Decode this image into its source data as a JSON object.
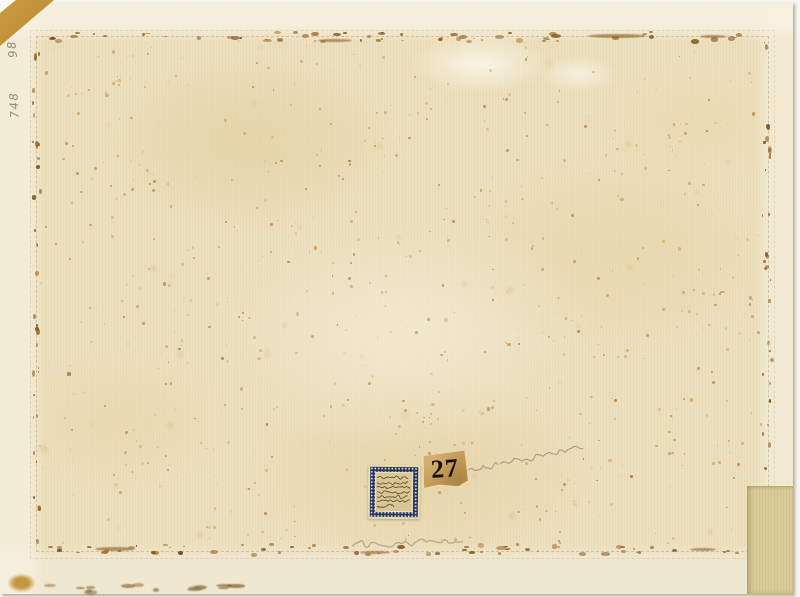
{
  "scan": {
    "description": "Back of an aged archival sheet with heavy foxing, a rectangular mount glue-line of brown specks, pasted collection labels and faint pencil notations",
    "inscriptions": {
      "number_tag": "27",
      "margin_number_top": "98",
      "margin_number_bottom": "748",
      "stamp_label_text": "illegible handwritten ink lines",
      "stamp_label_line_count": 7,
      "pencil_note_right": "illegible cursive pencil note",
      "pencil_note_bottom": "illegible cursive pencil note"
    },
    "colors": {
      "paper": "#ecdfbc",
      "paper_margin": "#f4eed9",
      "foxing_light": "#d2ab66",
      "foxing_mid": "#b97f33",
      "foxing_dark": "#a06a24",
      "glue_speck": "#8a5a1e",
      "backing_tan": "#c89a44",
      "patch_tan": "#d9cd97",
      "tag_paper": "#c69c58",
      "tag_ink": "#17100a",
      "stamp_navy": "#263361",
      "stamp_field": "#d8c794",
      "stamp_ink": "#4a3217",
      "pencil": "#6e6252",
      "scan_background": "#f7f6f0"
    },
    "decoration": {
      "seed": 7,
      "foxing_count": 420,
      "cluster_dot_count": 14,
      "soft_stain_count": 36,
      "margin_dot_count": 26,
      "bottom_edge_dash_count": 14,
      "border_speck_counts": {
        "top": 60,
        "bottom": 62,
        "left": 34,
        "right": 30
      }
    }
  }
}
